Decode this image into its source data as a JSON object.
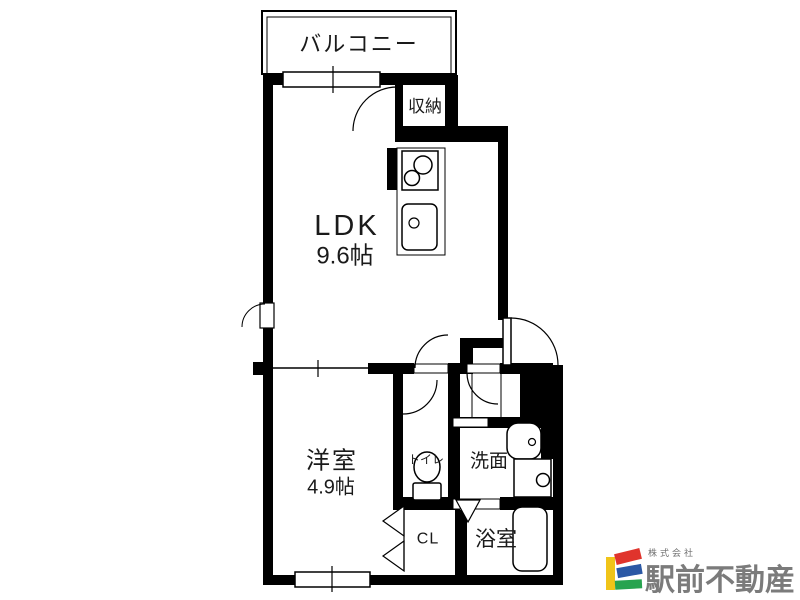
{
  "floorplan": {
    "balcony": "バルコニー",
    "storage": "収納",
    "ldk_name": "LDK",
    "ldk_size": "9.6帖",
    "western_room_name": "洋室",
    "western_room_size": "4.9帖",
    "toilet": "トイレ",
    "washroom": "洗面",
    "closet": "CL",
    "bathroom": "浴室"
  },
  "branding": {
    "company_prefix": "株式会社",
    "company_name": "駅前不動産",
    "logo_colors": {
      "yellow": "#f0c419",
      "red": "#e0342c",
      "blue": "#2b58a5",
      "green": "#27a34f"
    },
    "text_color": "#7b7b7b"
  }
}
